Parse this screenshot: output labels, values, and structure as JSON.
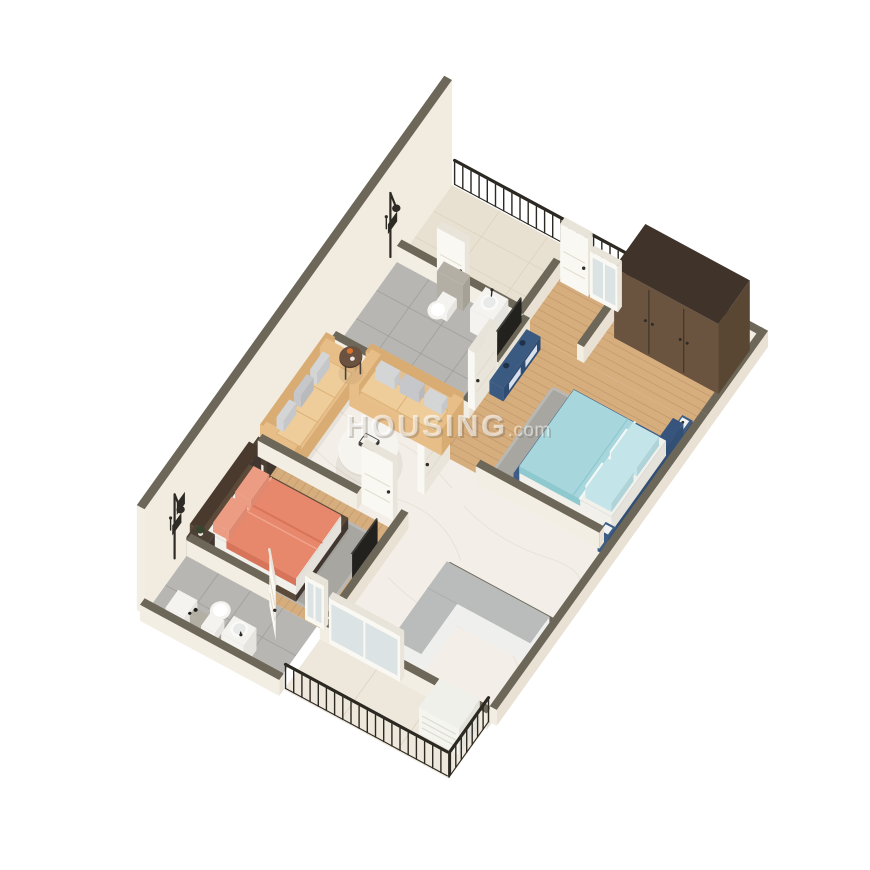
{
  "watermark": {
    "brand": "HOUSING",
    "suffix": ".com"
  },
  "scene": {
    "type": "3d-isometric-floor-plan-render",
    "rooms": [
      {
        "name": "balcony-top",
        "floor": "beige-marble",
        "features": [
          "black-metal-railing"
        ]
      },
      {
        "name": "bathroom-master",
        "floor": "grey-tile",
        "features": [
          "shower-set",
          "wall-hung-toilet",
          "washbasin",
          "balcony-door"
        ]
      },
      {
        "name": "bedroom-master",
        "floor": "wood-plank",
        "features": [
          "double-bed-blue",
          "teal-bedding",
          "tv-console-navy",
          "wall-tv",
          "wardrobe-niche",
          "balcony-door",
          "window",
          "grey-rug"
        ]
      },
      {
        "name": "wardrobe-niche",
        "floor": "wood-plank",
        "features": [
          "dark-brown-wardrobe"
        ]
      },
      {
        "name": "living-room",
        "floor": "white-marble",
        "features": [
          "three-seater-sofa",
          "two-seater-sofa",
          "round-marble-coffee-table",
          "round-side-table",
          "grey-pillows"
        ]
      },
      {
        "name": "bedroom-second",
        "floor": "wood-plank",
        "features": [
          "double-bed-coral",
          "nightstand-left",
          "nightstand-right",
          "wall-tv",
          "grey-rug",
          "door-open"
        ]
      },
      {
        "name": "bathroom-common",
        "floor": "grey-tile",
        "features": [
          "shower-set",
          "toilet",
          "washbasin",
          "door-open"
        ]
      },
      {
        "name": "kitchen",
        "floor": "white-marble",
        "features": [
          "l-shaped-grey-counter",
          "half-wall",
          "sliding-window"
        ]
      },
      {
        "name": "balcony-bottom",
        "floor": "beige-marble",
        "features": [
          "black-metal-railing",
          "ac-outdoor-unit"
        ]
      }
    ]
  },
  "colors": {
    "bg": "#ffffff",
    "wallTop": "#6c6758",
    "wallFaceLight": "#f3eee3",
    "wallFaceShade": "#e9e2d4",
    "tallWall": "#f1ecdf",
    "marble": "#f3efe8",
    "marbleVein": "#e6dfd3",
    "balcony1Floor": "#e8e1d2",
    "balcony2Floor": "#eee8dc",
    "balconyLine": "#dcd2bf",
    "wood": "#d6ad7d",
    "woodLine": "#c2986a",
    "tile": "#b7b6b2",
    "tileLine": "#a3a19c",
    "rug": "#a7a6a1",
    "rugEdge": "#b9b8b3",
    "shadow": "rgba(80,70,50,0.08)",
    "sofa": "#e8be88",
    "sofaShade": "#d9ac74",
    "cushion": "#eecd9b",
    "pillowGray": "#d4d5d6",
    "pillowGray2": "#c5c7ca",
    "coffeeTop": "#f6f4ef",
    "coffeeEdge": "#ded8cd",
    "tableLeg": "#4a423a",
    "sideTableTop": "#6b5140",
    "sideTableEdge": "#523d2c",
    "decoOrange": "#d7722f",
    "decoWhite": "#ece8df",
    "bedOBlanket": "#e7876b",
    "bedOFold": "#d8745a",
    "bedOHem": "#f2ab93",
    "bedOPillow": "#ec9c83",
    "mattress": "#f2f0ea",
    "mattressShade": "#e4e2da",
    "bedOFrame": "#5b493a",
    "bedOHead": "#4a3a2e",
    "nightstand": "#4d4136",
    "nightstandShade": "#423730",
    "drawerWhite": "#f0eee8",
    "plantGreen": "#36452f",
    "potWhite": "#e9e5dc",
    "bedBFrame": "#3d5c85",
    "bedBFrameShade": "#324f75",
    "bedBHead": "#36547c",
    "bedding": "#a7d7dc",
    "beddingFold": "#8fc9d0",
    "pillowTeal": "#c3e4e8",
    "pillowWhite": "#f3f7f7",
    "consoleNavy": "#3a5a82",
    "consoleShade": "#2f4d73",
    "consoleDetail": "#d9e2ec",
    "wardrobeTop": "#3f332a",
    "wardrobeFace": "#6b543f",
    "wardrobeSide": "#594733",
    "wardrobeSeam": "#43352a",
    "tv": "#22211e",
    "tvTop": "#3b3b37",
    "doorFace": "#faf8f3",
    "doorShade": "#eae5da",
    "doorTop": "#e9e4d9",
    "doorGroove": "#e2dbcc",
    "handle": "#2f2c28",
    "pane": "#d9e1e3",
    "railing": "#2c2822",
    "counterTop": "#b9bcbb",
    "counterFace": "#eff0ee",
    "fixture": "#2e2b26",
    "toilet": "#f4f3ef",
    "toiletShade": "#e6e4de",
    "cistern": "#b3afa5",
    "cisternShade": "#a5a196",
    "acWhite": "#f0f0ea",
    "acShade": "#e3e3dc",
    "acFace": "#f5f5ef",
    "acSlat": "#dcdcd4"
  }
}
